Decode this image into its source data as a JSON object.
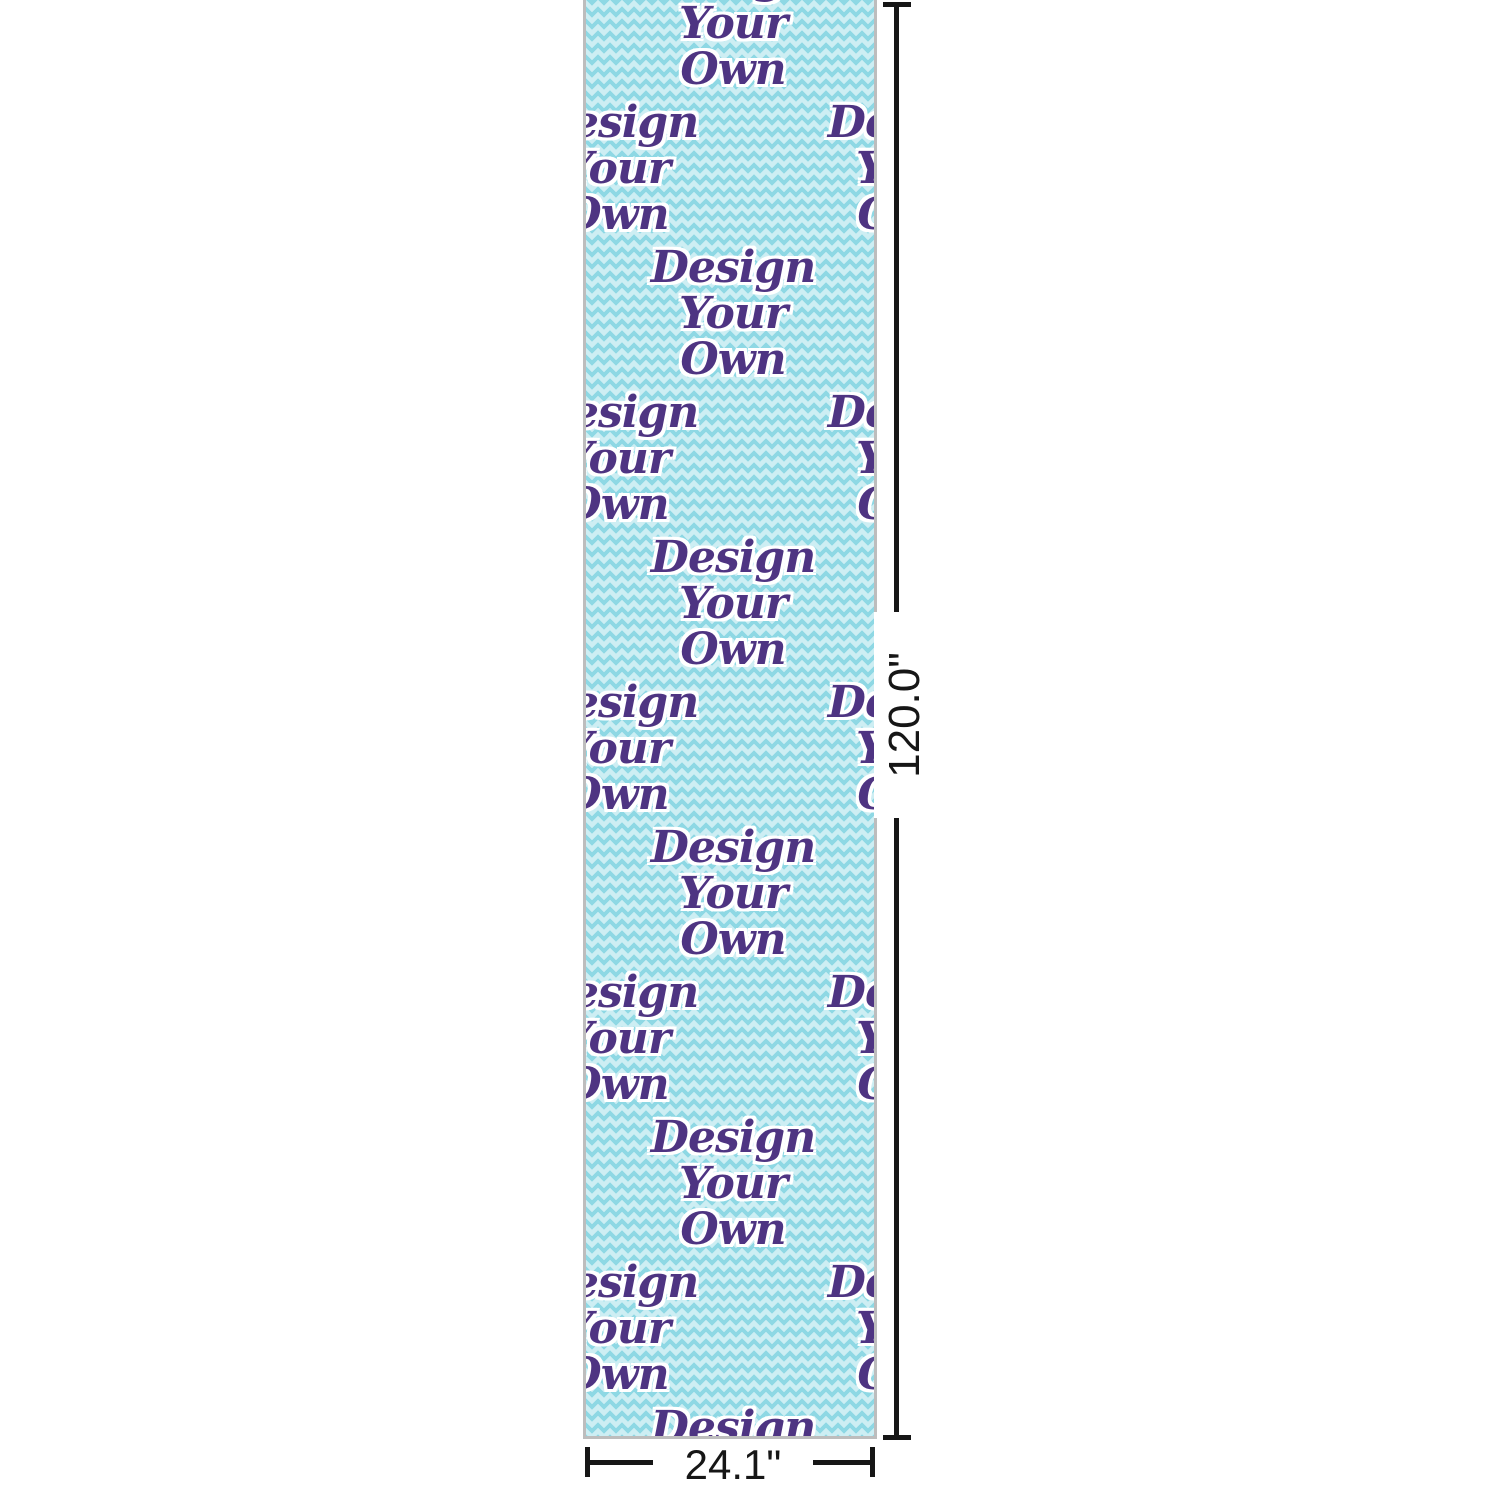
{
  "product": {
    "type": "patterned-strip-preview",
    "pattern_words": [
      "Design",
      "Your",
      "Own"
    ],
    "colors": {
      "chevron_light": "#cdeef3",
      "chevron_dark": "#8ed8e4",
      "script_purple": "#4e3482",
      "text_outline": "#ffffff",
      "strip_border": "#bdbdbd"
    }
  },
  "dimensions": {
    "height_label": "120.0\"",
    "width_label": "24.1\"",
    "line_color": "#161616"
  }
}
